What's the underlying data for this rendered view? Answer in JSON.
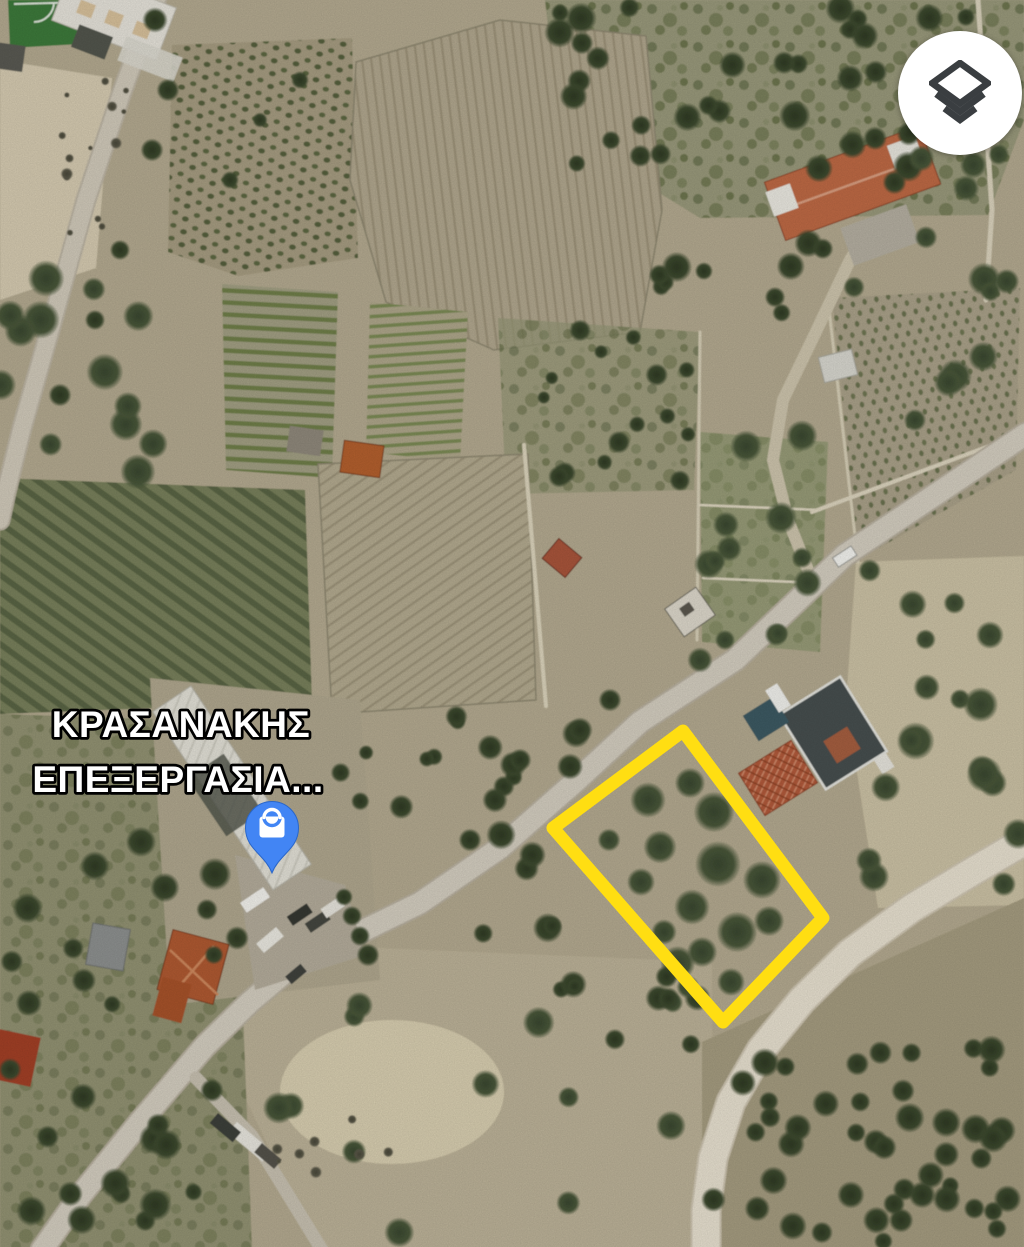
{
  "place_label": {
    "line1": "ΚΡΑΣΑΝΑΚΗΣ",
    "line2": "ΕΠΕΞΕΡΓΑΣΙΑ...",
    "text_color": "#ffffff",
    "outline_color": "#000000"
  },
  "marker": {
    "type": "place-pin",
    "category_icon": "shopping-bag-icon",
    "pin_color": "#4285F4",
    "glyph_color": "#ffffff"
  },
  "plot_outline": {
    "color": "#FFDE12",
    "stroke_width": 13
  },
  "controls": {
    "layers_button": {
      "icon": "layers-icon",
      "background_color": "#ffffff",
      "glyph_color": "#3a3e41"
    }
  }
}
